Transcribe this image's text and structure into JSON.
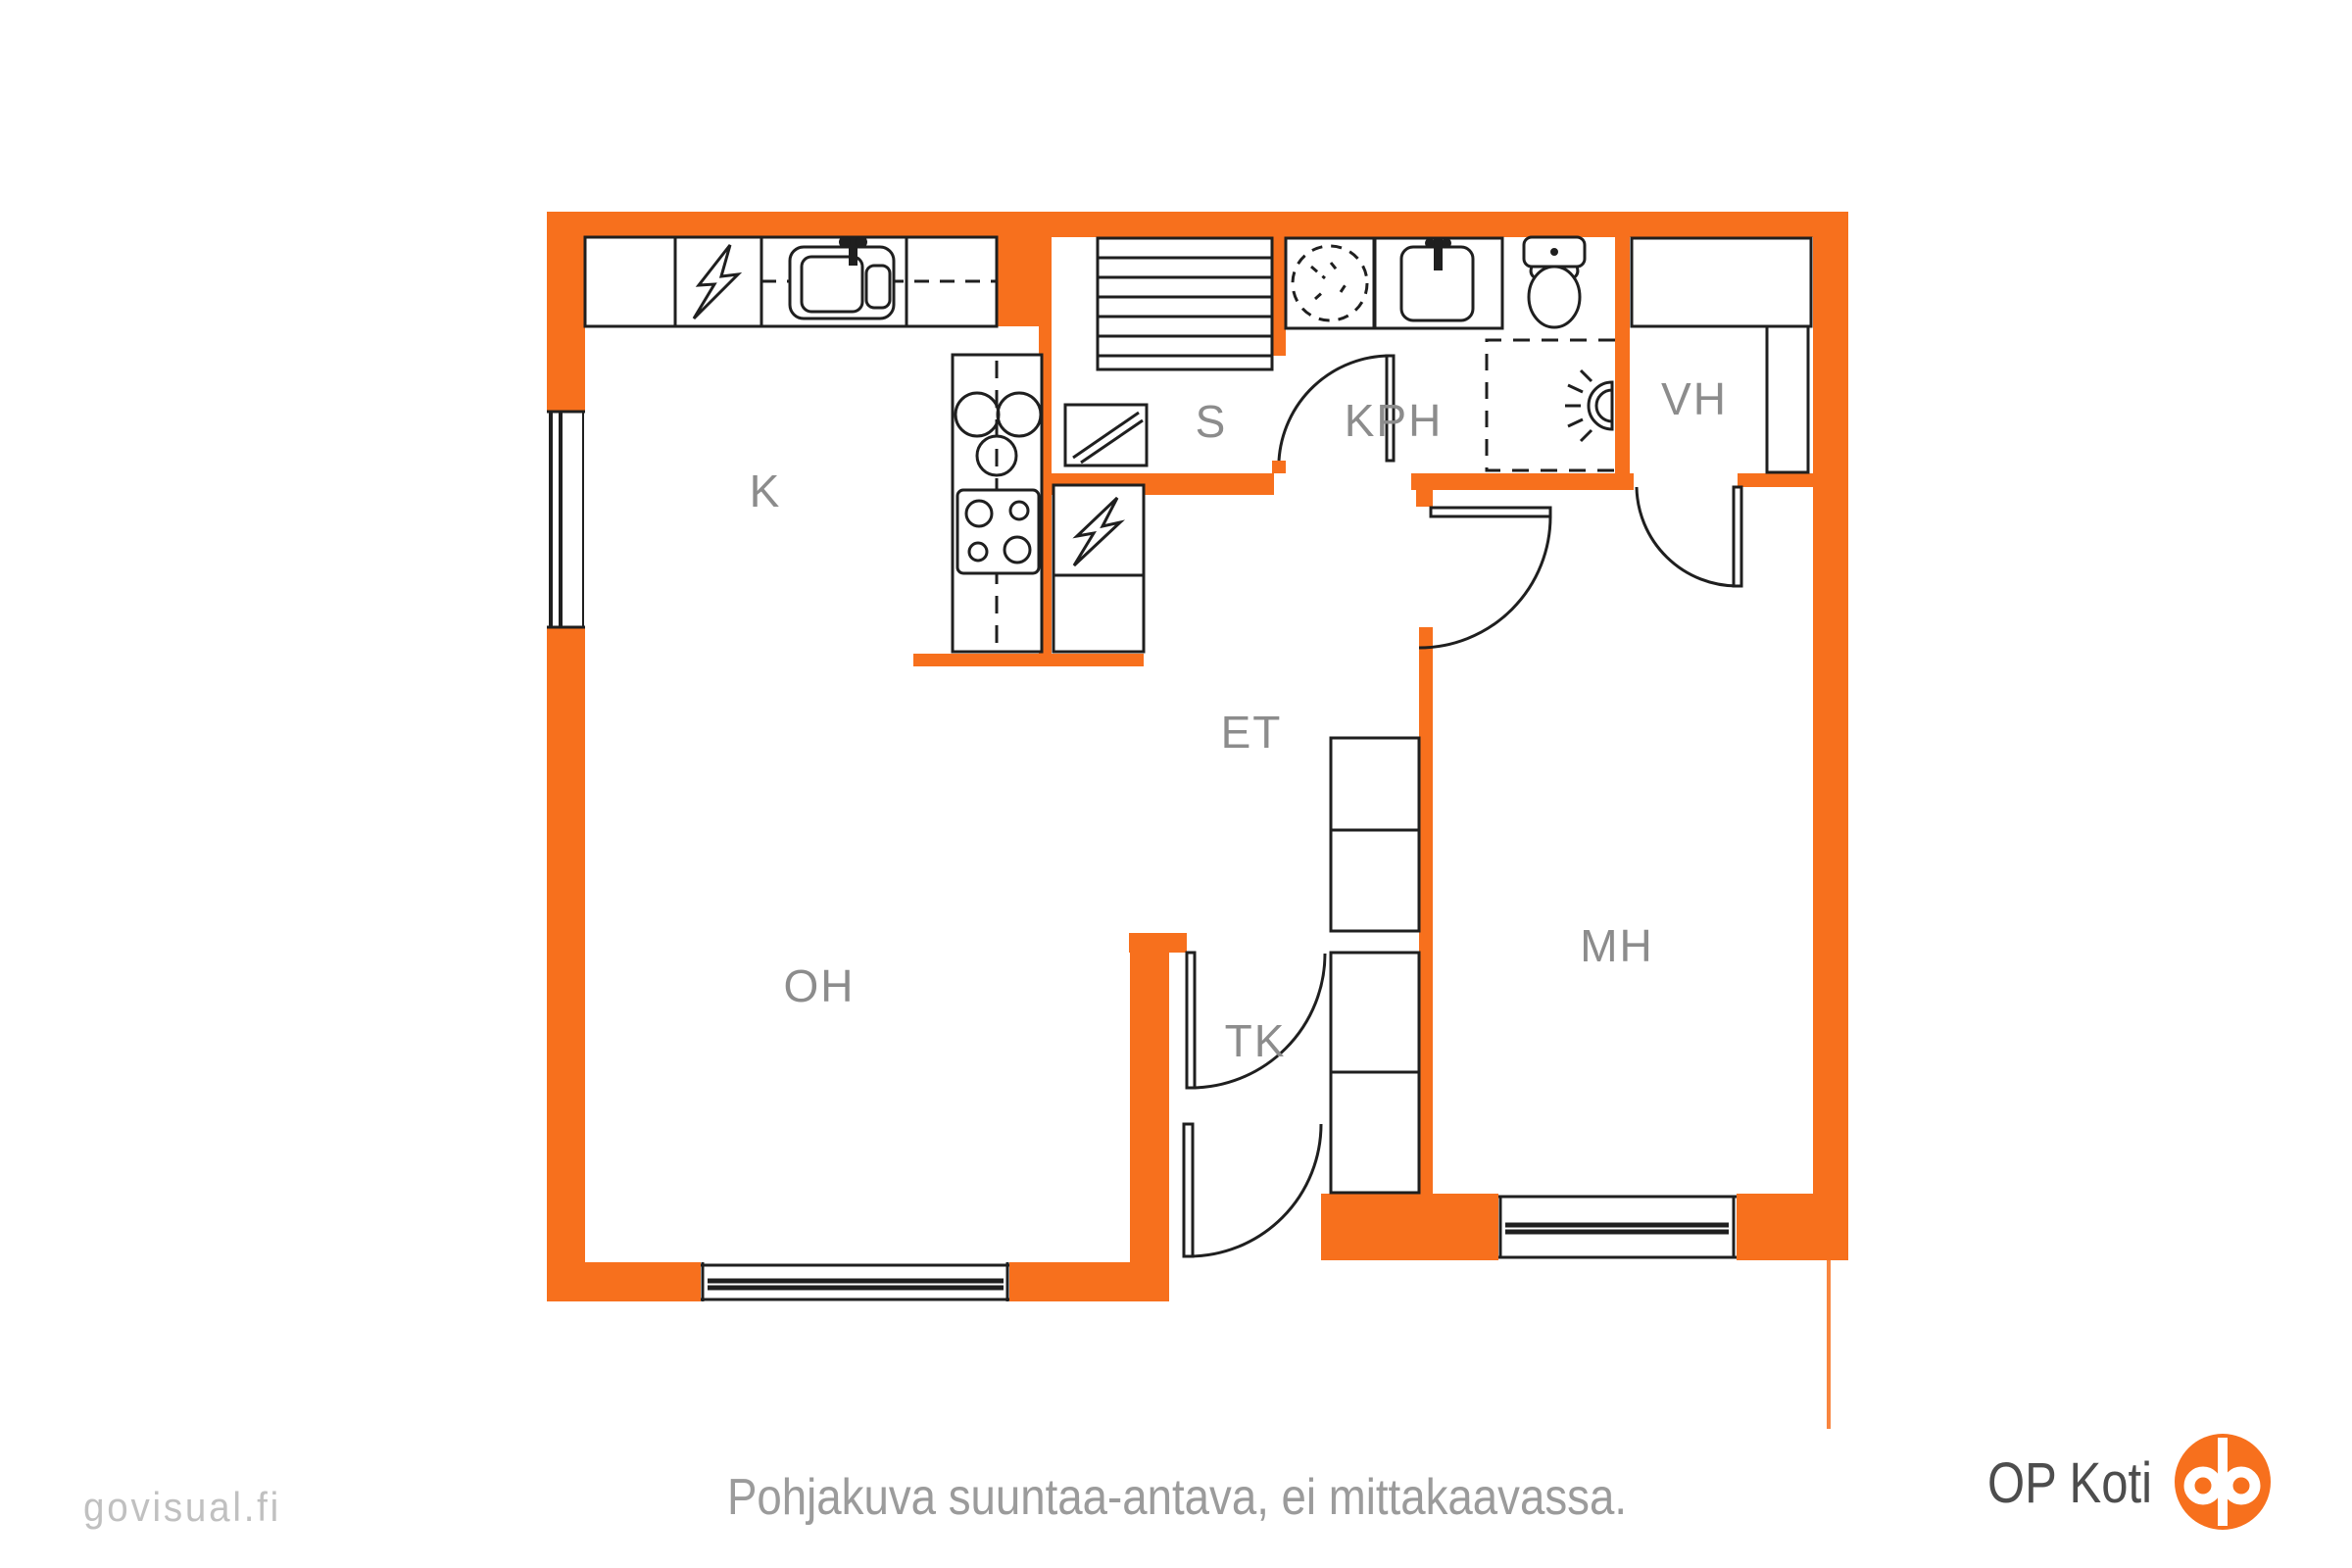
{
  "meta": {
    "type": "floor-plan",
    "language": "Finnish"
  },
  "colors": {
    "wall_orange": "#F7701D",
    "drawing_line": "#1f1f1f",
    "room_label_gray": "#8c8c8c",
    "footer_gray": "#9b9b9b",
    "watermark_gray": "#c0c0c0",
    "brand_text_gray": "#4d4d4d",
    "logo_orange": "#F7701D",
    "background": "#ffffff"
  },
  "rooms": {
    "kitchen": "K",
    "sauna": "S",
    "bathroom": "KPH",
    "walkin_closet": "VH",
    "hall": "ET",
    "bedroom": "MH",
    "living_room": "OH",
    "vestibule": "TK"
  },
  "icons": {
    "appliance_lightning": "lightning-bolt-icon",
    "kitchen_sink": "double-basin-sink-icon",
    "stove_top": "four-burner-cooktop-icon",
    "hotplates": "stove-rings-icon",
    "sauna_benches": "sauna-bench-slats-icon",
    "sauna_heater": "hatched-square-kiuas-icon",
    "washing_machine": "dashed-circle-washer-icon",
    "bathroom_sink": "washbasin-icon",
    "toilet": "wc-toilet-icon",
    "shower_area": "dashed-shower-zone-icon",
    "wall_lamp": "half-round-lamp-icon",
    "windows": "double-line-window-icon",
    "doors": "quarter-arc-door-icon",
    "op_logo": "op-circle-monogram-icon"
  },
  "footer": {
    "disclaimer": "Pohjakuva suuntaa-antava, ei mittakaavassa."
  },
  "watermark": {
    "text": "govisual.fi"
  },
  "brand": {
    "name": "OP Koti"
  }
}
